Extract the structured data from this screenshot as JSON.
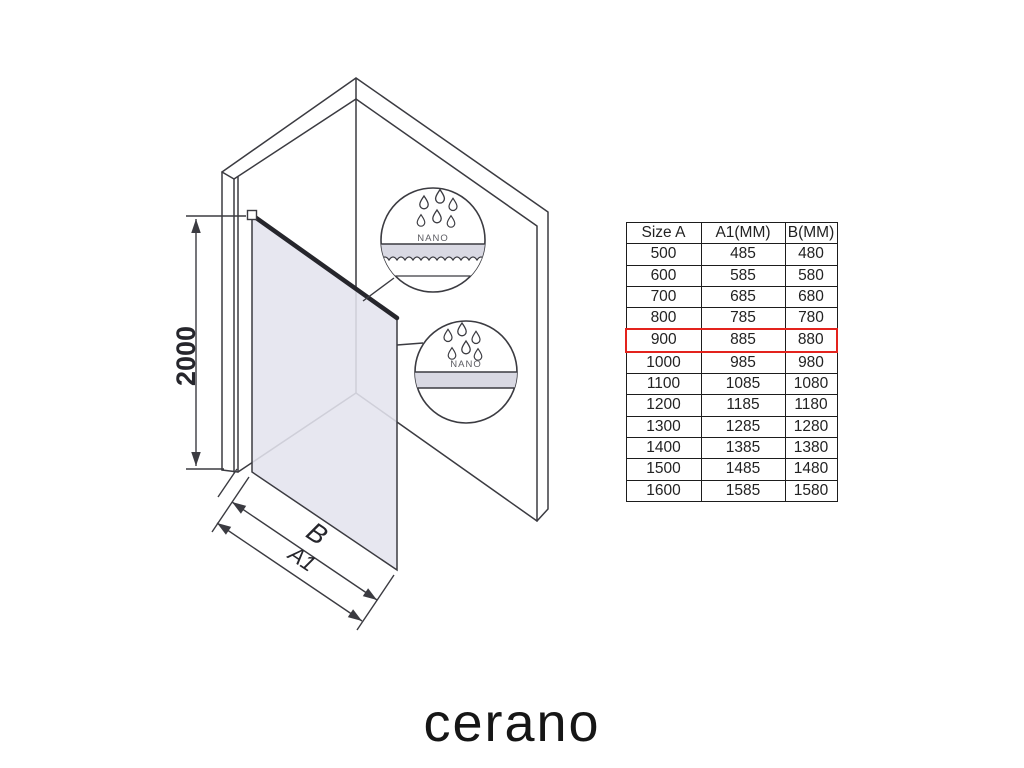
{
  "brand": {
    "logo_text": "cerano"
  },
  "diagram": {
    "height_label": "2000",
    "width_label_b": "B",
    "width_label_a1": "A1",
    "callout_top": {
      "label": "NANO"
    },
    "callout_bottom": {
      "label": "NANO"
    },
    "colors": {
      "line": "#3b3b41",
      "glass_fill": "#e4e4ee",
      "band_fill": "#d9d9e3",
      "highlight_red": "#e3231d"
    }
  },
  "table": {
    "headers": [
      "Size A",
      "A1(MM)",
      "B(MM)"
    ],
    "rows": [
      [
        "500",
        "485",
        "480"
      ],
      [
        "600",
        "585",
        "580"
      ],
      [
        "700",
        "685",
        "680"
      ],
      [
        "800",
        "785",
        "780"
      ],
      [
        "900",
        "885",
        "880"
      ],
      [
        "1000",
        "985",
        "980"
      ],
      [
        "1100",
        "1085",
        "1080"
      ],
      [
        "1200",
        "1185",
        "1180"
      ],
      [
        "1300",
        "1285",
        "1280"
      ],
      [
        "1400",
        "1385",
        "1380"
      ],
      [
        "1500",
        "1485",
        "1480"
      ],
      [
        "1600",
        "1585",
        "1580"
      ]
    ],
    "highlighted_row_index": 4
  }
}
